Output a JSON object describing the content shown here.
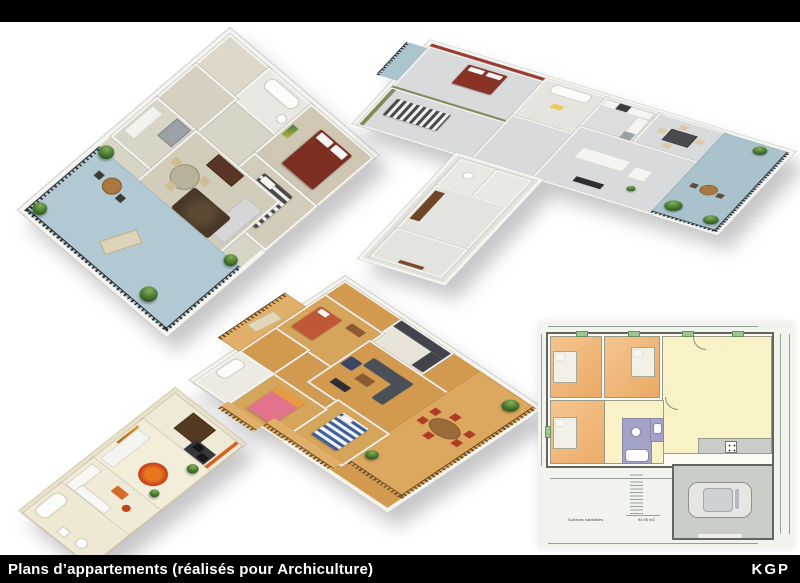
{
  "poster": {
    "width": 800,
    "height": 583,
    "background": "#ffffff"
  },
  "header": {
    "bar_color": "#000000"
  },
  "footer": {
    "caption": "Plans d’appartements (réalisés pour Archiculture)",
    "brand": "KGP",
    "bg_color": "#000000",
    "text_color": "#ffffff"
  },
  "plans": [
    {
      "id": "plan-3d-terrace-corner",
      "position": "top-left",
      "type": "3d-isometric"
    },
    {
      "id": "plan-3d-t-shape",
      "position": "top-right",
      "type": "3d-isometric"
    },
    {
      "id": "plan-3d-parquet-large-terrace",
      "position": "center",
      "type": "3d-isometric"
    },
    {
      "id": "plan-3d-studio",
      "position": "bottom-left",
      "type": "3d-isometric"
    },
    {
      "id": "plan-2d-pavillon-garage",
      "position": "bottom-right",
      "type": "2d-drawing"
    }
  ],
  "plan2d": {
    "surface_label": "Surfaces habitables",
    "surface_total": "94,95 m2"
  },
  "palette": {
    "terrace_blue": "#b2c9d3",
    "tile_floor": "#d2ccba",
    "gray_floor": "#d8dadb",
    "wood_floor": "#d29a4e",
    "wood_light": "#e0b06a",
    "wall_white": "#f7f7f4",
    "wall_cream": "#e9e2ca",
    "accent_red_wall": "#9a3c32",
    "accent_green_wall": "#7e8b57",
    "accent_orange_wall": "#d4601f",
    "bed_red": "#7c2f20",
    "bed_blue_stripe": "#3c5f9e",
    "bed_pink": "#e2738c",
    "plan2d_bedroom": "#f0bc80",
    "plan2d_living": "#f8f2c6",
    "plan2d_bath": "#a3a3c9",
    "plan2d_garage": "#c9cdc7",
    "plan2d_paper": "#f0f4ec"
  }
}
